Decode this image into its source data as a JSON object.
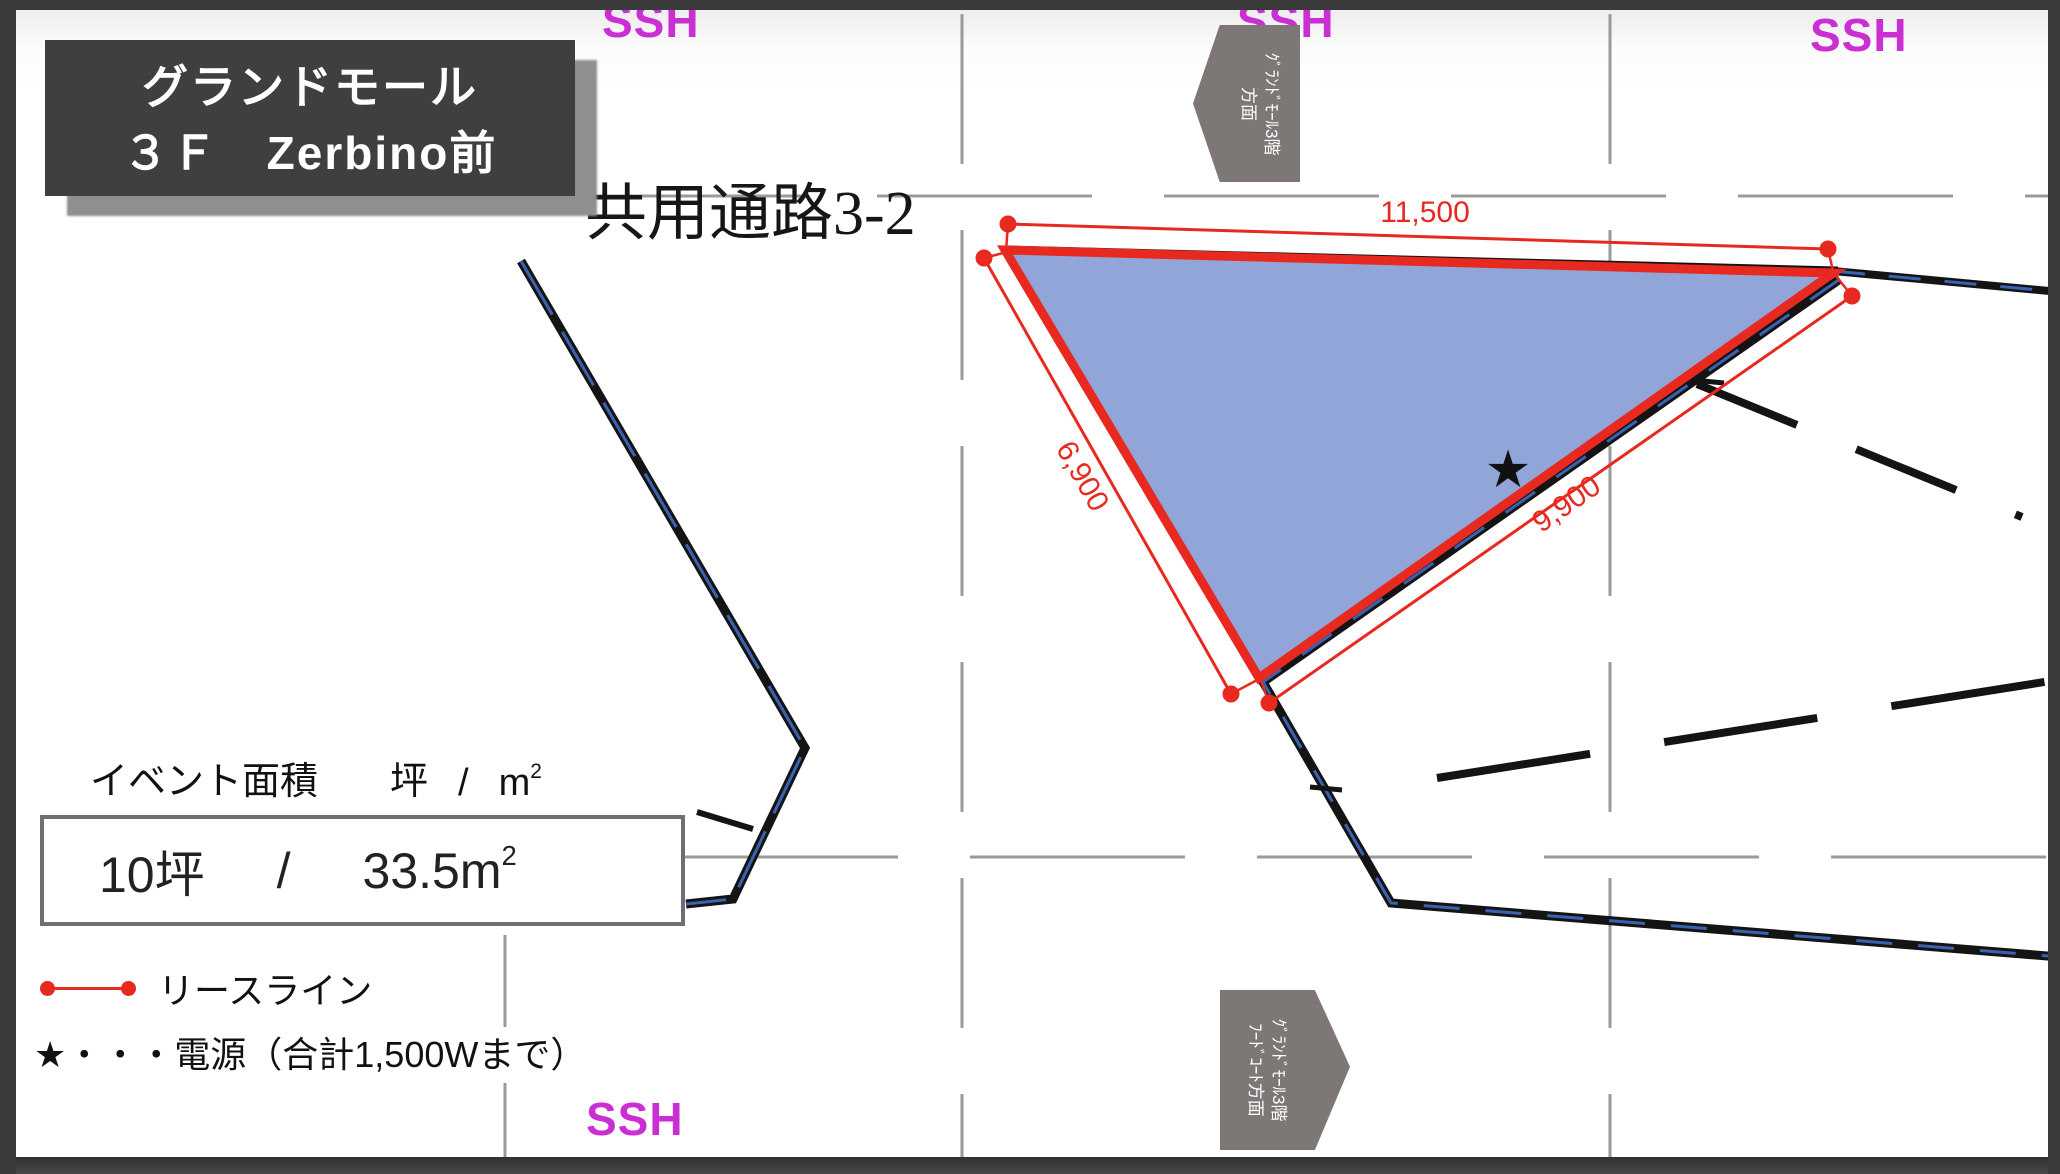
{
  "title_card": {
    "line1": "グランドモール",
    "line2": "３Ｆ　Zerbino前"
  },
  "corridor_label": "共用通路3-2",
  "ssh_labels": {
    "top_left": "SSH",
    "top_middle": "SSH",
    "top_right": "SSH",
    "bottom": "SSH",
    "color": "#cb2ed2"
  },
  "direction_signs": {
    "top": {
      "line1": "ｸﾞﾗﾝﾄﾞﾓｰﾙ3階",
      "line2": "方面",
      "points": "left"
    },
    "bottom": {
      "line1": "ｸﾞﾗﾝﾄﾞﾓｰﾙ3階",
      "line2": "ﾌｰﾄﾞｺｰﾄ方面",
      "points": "right"
    }
  },
  "lease_area": {
    "dimension_top": "11,500",
    "dimension_left": "6,900",
    "dimension_diagonal": "9,900",
    "power_star": "★"
  },
  "area_panel": {
    "label_title": "イベント面積",
    "label_tsubo": "坪",
    "label_slash": "/",
    "label_m2_base": "m",
    "label_m2_sup": "2",
    "value_tsubo": "10坪",
    "value_slash": "/",
    "value_m2_base": "33.5m",
    "value_m2_sup": "2"
  },
  "legend": {
    "lease_line_label": "リースライン",
    "power_label": "★・・・電源（合計1,500Wまで）"
  },
  "colors": {
    "lease_red": "#e8291f",
    "area_fill": "#92a5d8",
    "wall_black": "#141414",
    "wall_blue": "#3a62b2",
    "grid_gray": "#9a9a9a",
    "sign_gray": "#7d7876",
    "title_bg": "#3f3f3f",
    "ssh_magenta": "#cb2ed2",
    "frame_dark": "#3a3a3a"
  }
}
